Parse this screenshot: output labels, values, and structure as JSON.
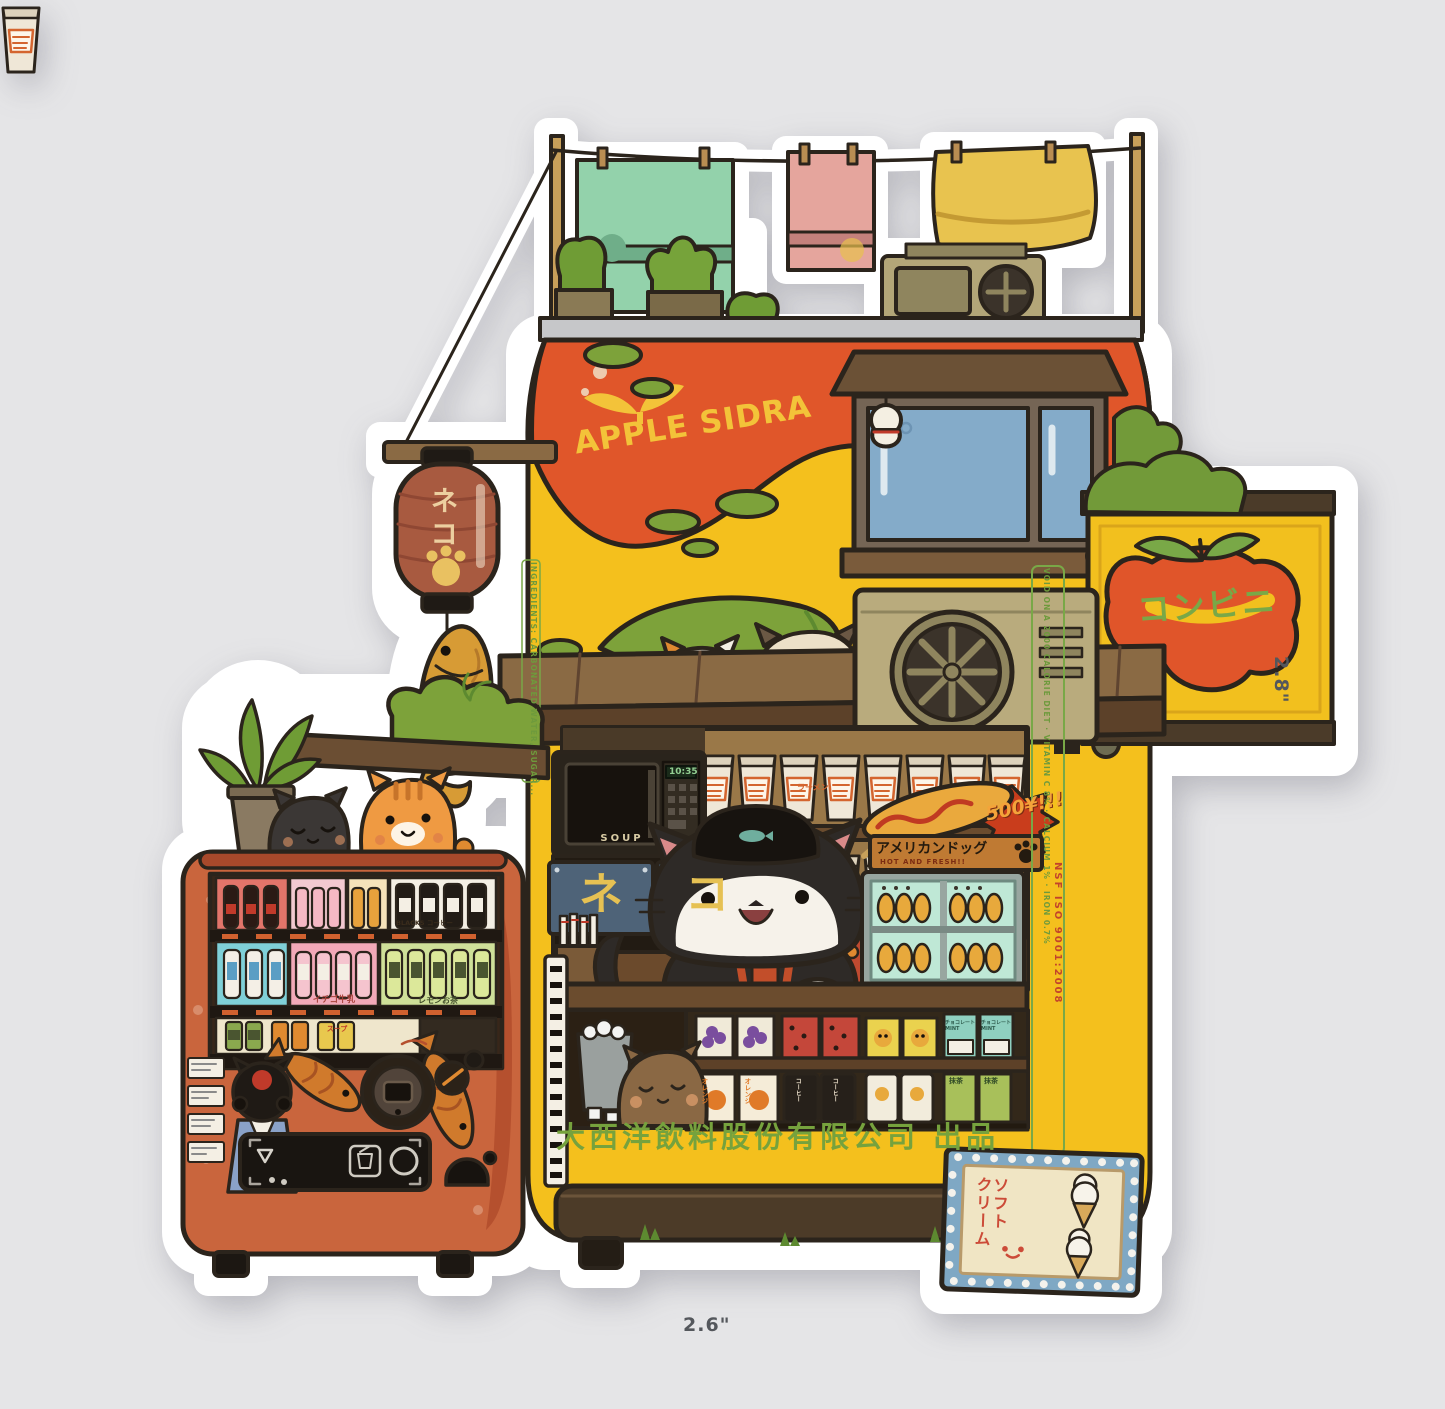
{
  "scene": {
    "background_color": "#e5e5e7",
    "subject": "Die-cut vinyl sticker of a cat-run Japanese convenience-store kiosk with vending machine",
    "width_label": "2.6\"",
    "height_label": "2.8\""
  },
  "kiosk": {
    "brand": "APPLE SIDRA",
    "sign_konbini": "コンビニ",
    "counter_sign_chars": [
      "ネ",
      "コ"
    ],
    "microwave_label": "SOUP",
    "microwave_clock": "10:35",
    "cup_ramen_label": "ラーメン",
    "corndog": {
      "title": "アメリカンドッグ",
      "subtitle": "HOT AND FRESH!!",
      "price": "500¥!!!"
    },
    "company_text": "大西洋飲料股份有限公司 出品",
    "softcream_sign": "ソフト\nクリーム",
    "ingredients_text": "INGREDIENTS: CARBONATED WATER, SUGAR...",
    "nutrition_text": "VOID ON A 2000 CALORIE DIET · VITAMIN C 8% · CALCIUM 1% · IRON 0.7%",
    "iso_text": "NSF ISO 9001:2008",
    "labels": {
      "choco_mint": "チョコレート MINT",
      "coffee_can": "コーヒー",
      "matcha": "抹茶",
      "orange_juice": "オレンジ"
    }
  },
  "lantern": {
    "text": "ネコ"
  },
  "vending": {
    "coffee_caption": "BLACKS コーヒー",
    "strawberry_caption": "イチゴ牛乳",
    "lemon_caption": "レモンお茶",
    "soup_can": "スープ"
  },
  "colors": {
    "sticker_white": "#ffffff",
    "kiosk_yellow": "#f4c01d",
    "kiosk_orange": "#e0562a",
    "vending_red": "#c9653d",
    "awning_brown": "#8a6a44",
    "sign_text_green": "#79a847",
    "company_green": "#76a23d",
    "dimension_gray": "#54575c"
  }
}
